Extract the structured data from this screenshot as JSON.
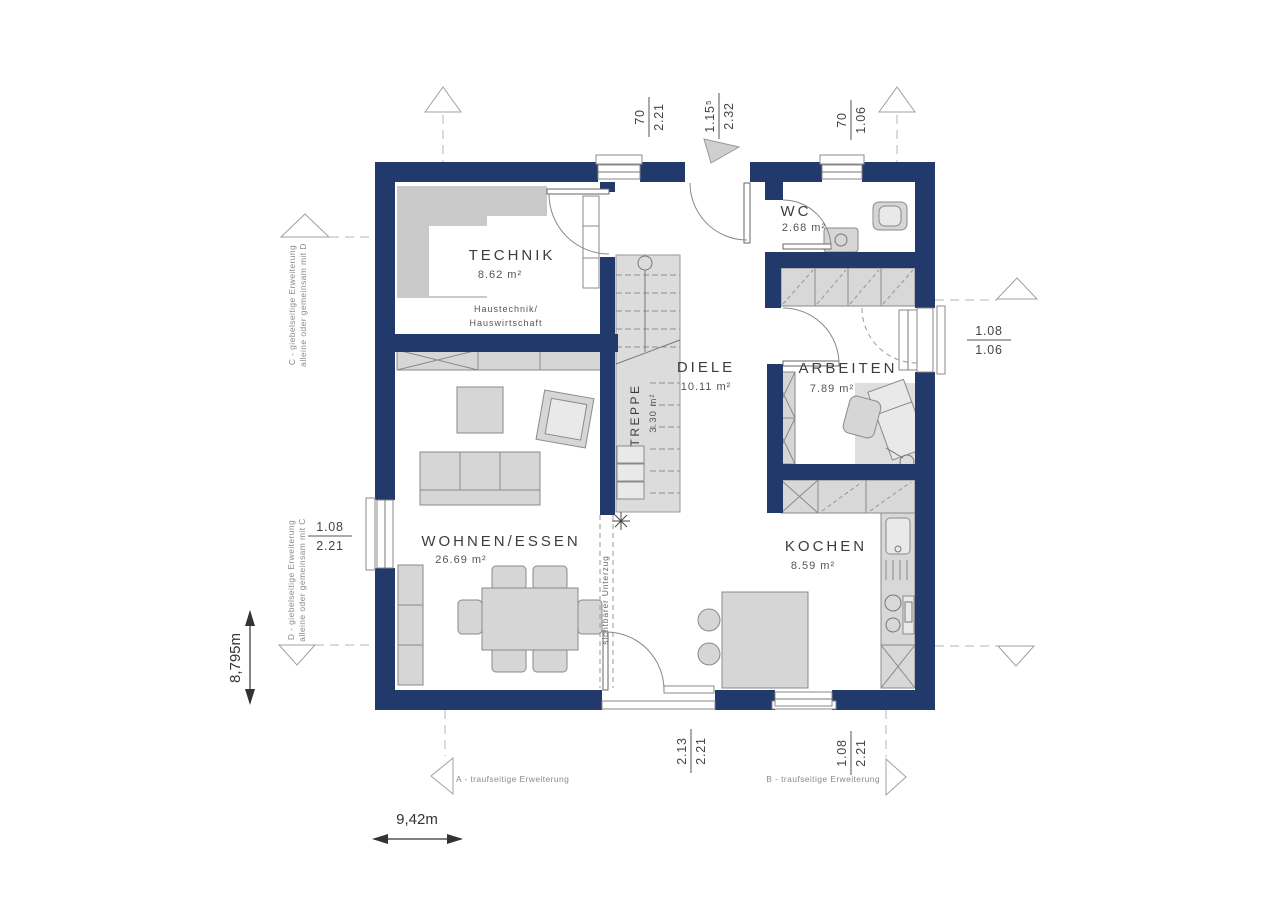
{
  "plan": {
    "rooms": {
      "technik": {
        "name": "TECHNIK",
        "area": "8.62 m²",
        "note1": "Haustechnik/",
        "note2": "Hauswirtschaft"
      },
      "wc": {
        "name": "WC",
        "area": "2.68 m²"
      },
      "diele": {
        "name": "DIELE",
        "area": "10.11 m²"
      },
      "treppe": {
        "name": "TREPPE",
        "area": "3.30 m²"
      },
      "arbeiten": {
        "name": "ARBEITEN",
        "area": "7.89 m²"
      },
      "wohnen": {
        "name": "WOHNEN/ESSEN",
        "area": "26.69 m²"
      },
      "kochen": {
        "name": "KOCHEN",
        "area": "8.59 m²"
      }
    },
    "beam_note": "sichtbarer Unterzug",
    "dims": {
      "top_window_technik": {
        "w": "70",
        "h": "2.21"
      },
      "top_entrance": {
        "w": "1.15⁵",
        "h": "2.32"
      },
      "top_window_wc": {
        "w": "70",
        "h": "1.06"
      },
      "right_window_arbeiten": {
        "w": "1.08",
        "h": "1.06"
      },
      "left_window_wohnen": {
        "w": "1.08",
        "h": "2.21"
      },
      "bottom_terrace_door": {
        "w": "2.13",
        "h": "2.21"
      },
      "bottom_window_kochen": {
        "w": "1.08",
        "h": "2.21"
      }
    },
    "extensions": {
      "a": "A - traufseitige Erweiterung",
      "b": "B - traufseitige Erweiterung",
      "c1": "C - giebelseitige Erweiterung",
      "c2": "alleine oder gemeinsam mit D",
      "d1": "D - giebelseitige Erweiterung",
      "d2": "alleine oder gemeinsam mit C"
    },
    "overall": {
      "width": "9,42m",
      "height": "8,795m"
    },
    "colors": {
      "wall": "#21396b",
      "furniture": "#d6d6d6",
      "shade": "#c9c9c9"
    }
  }
}
